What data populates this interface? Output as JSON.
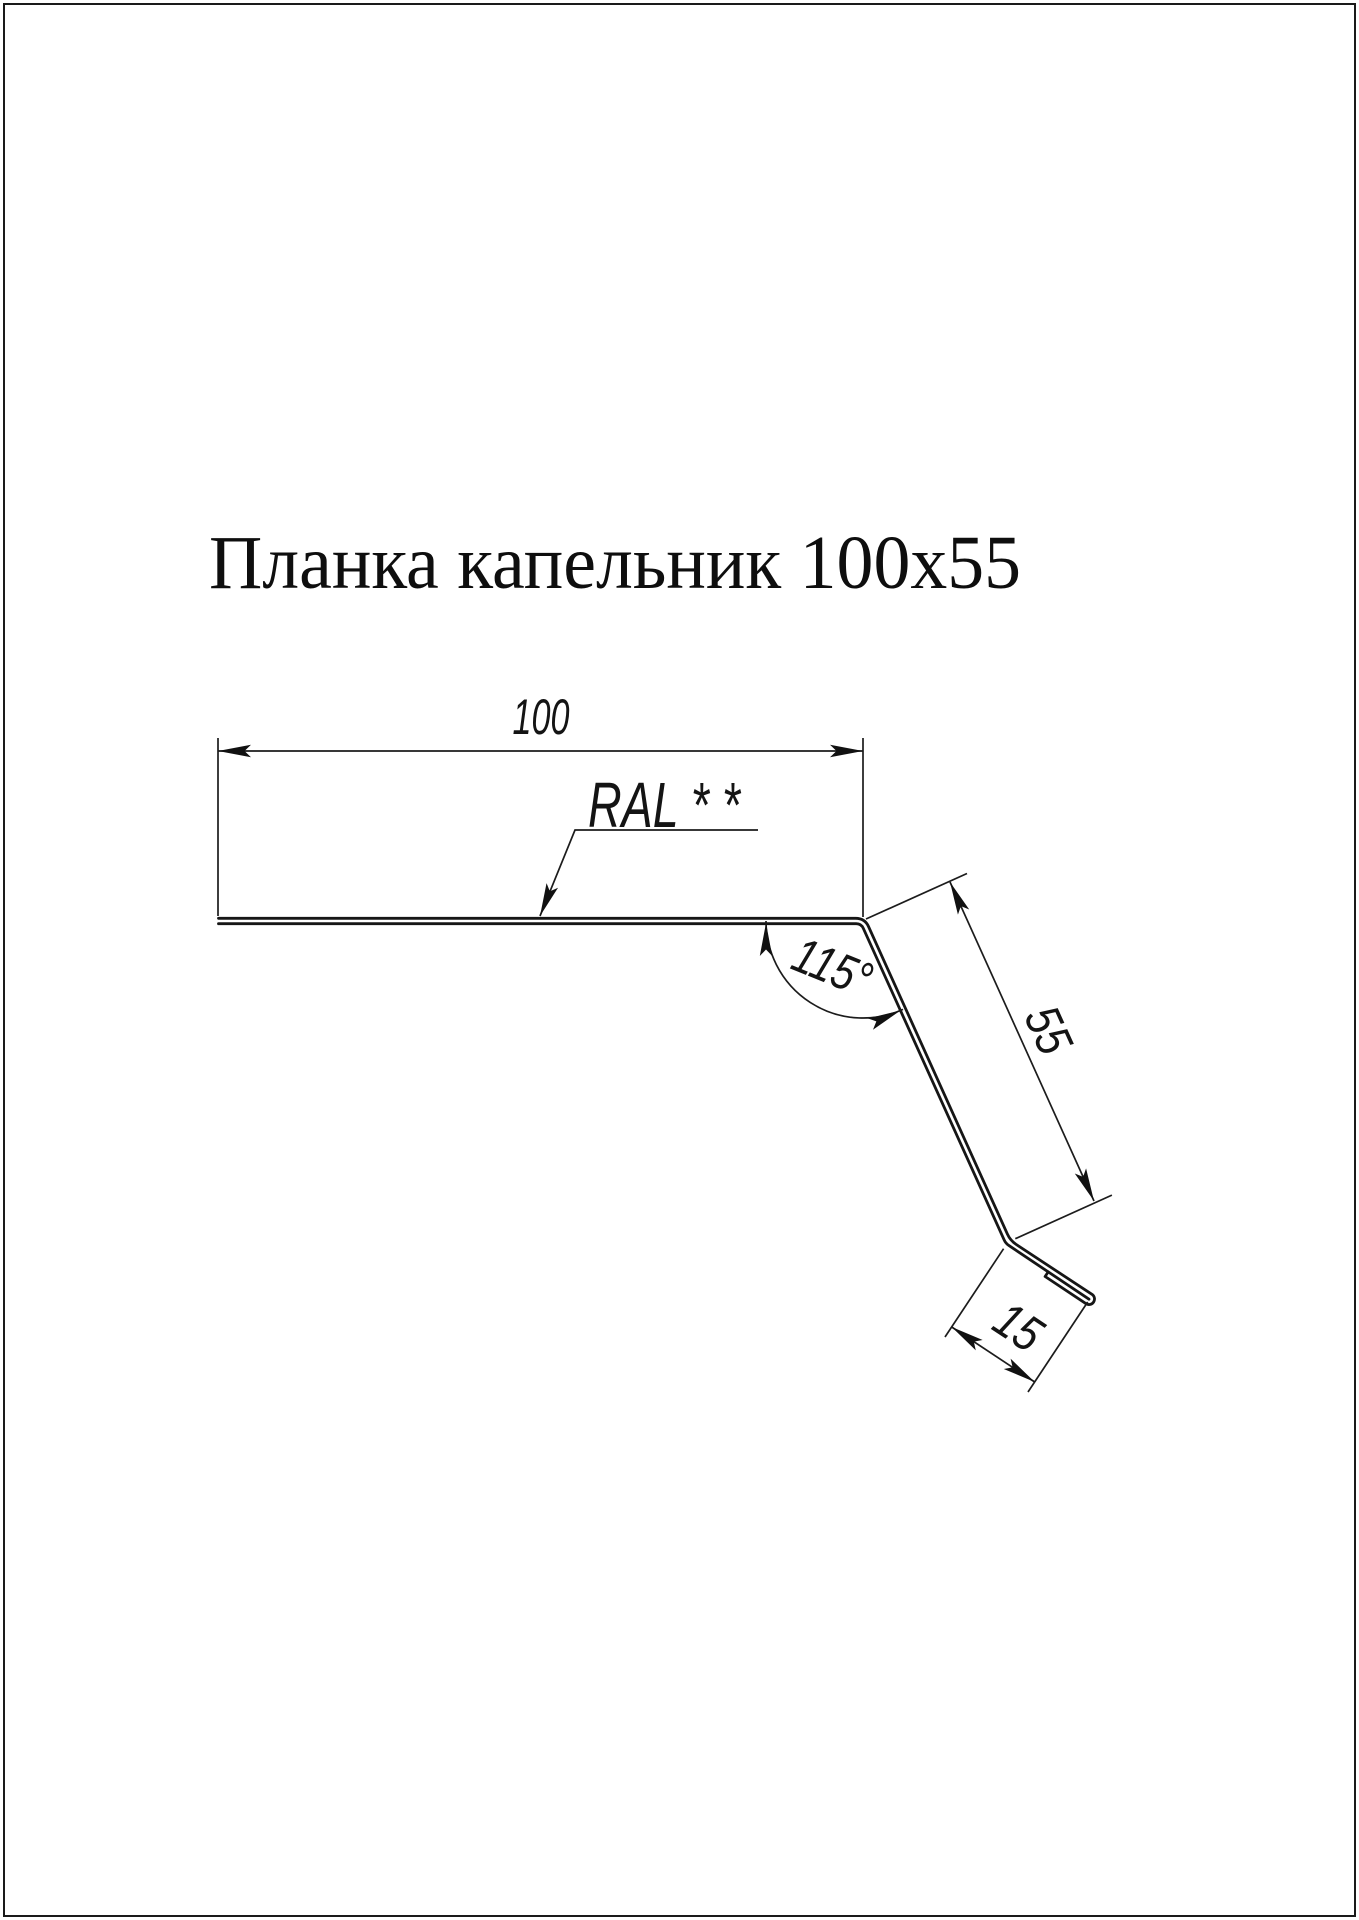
{
  "page": {
    "background": "#ffffff",
    "border_color": "#1a1a1a",
    "title": "Планка капельник 100x55"
  },
  "drawing": {
    "stroke_color": "#161616",
    "labels": {
      "width": "100",
      "web_height": "55",
      "lip": "15",
      "angle": "115°",
      "coating": "RAL * *"
    }
  }
}
